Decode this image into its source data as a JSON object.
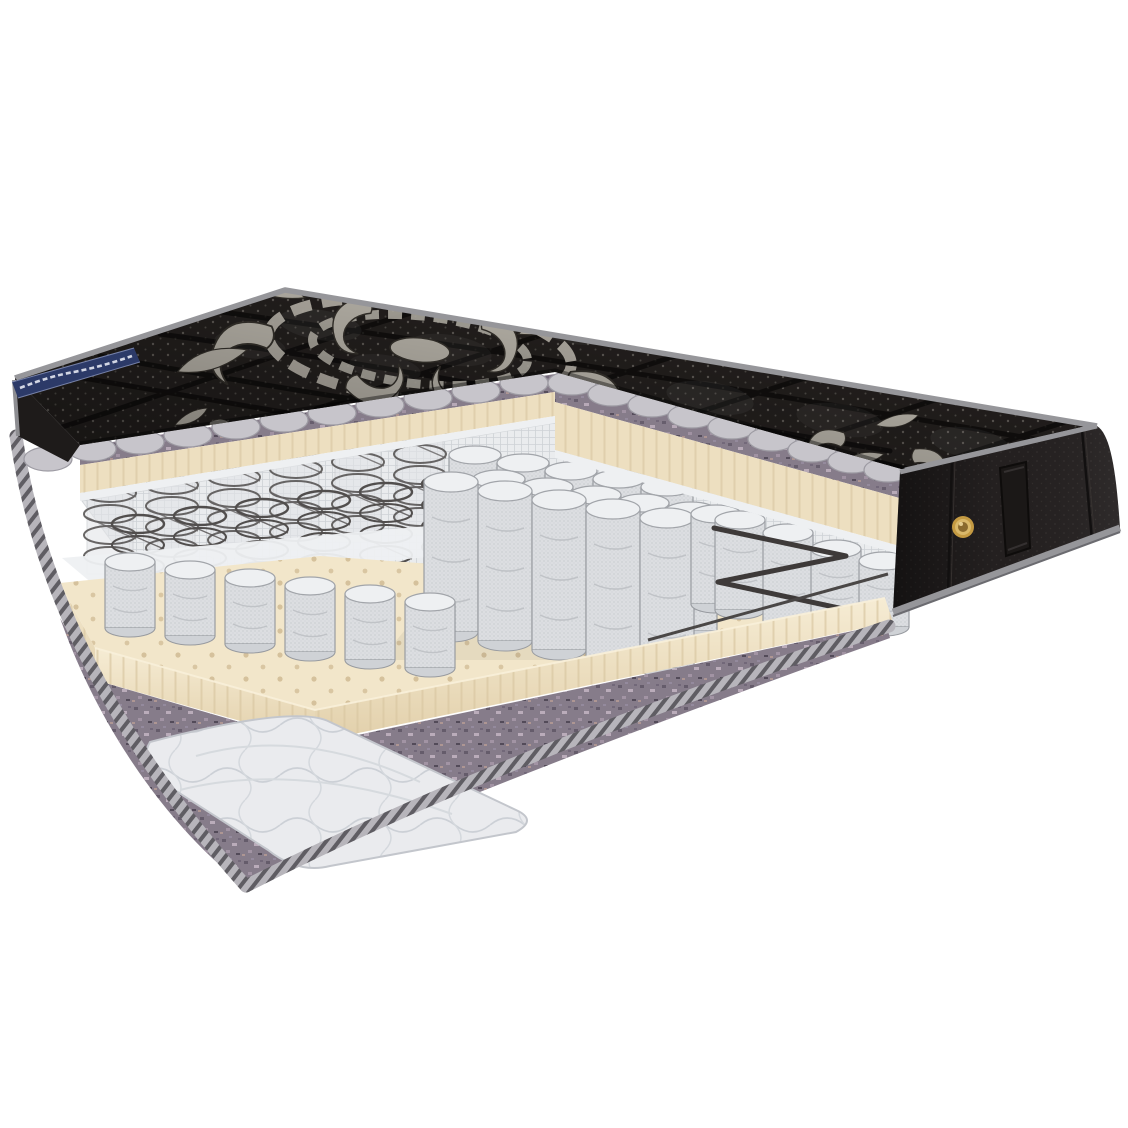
{
  "scene": {
    "description": "Cutaway product render of a mattress on a white background; the front-left quarter is sliced away to reveal internal layers",
    "background": "#ffffff"
  },
  "depicted_parts": [
    "black quilted top cover with silver damask embroidery and pin-dot fabric",
    "gray quilt backing with scalloped cut edge",
    "purple-gray felt pad",
    "perforated cream latex comfort layer",
    "white spring-cover fabric",
    "open steel coil springs",
    "independent pocket springs (raised block)",
    "zigzag border wire",
    "perforated cream latex base layer with stepped cut",
    "felt base pad",
    "white quilted base cover corner",
    "gray striped edge binding",
    "black side panel with vertical handle and brass air vent",
    "navy brand ribbon with illegible white script on the top-left edge"
  ],
  "brand_ribbon": {
    "color": "#2c3a68",
    "script_color": "#e4e8f2"
  },
  "colors": {
    "background": "#ffffff",
    "cover_black": "#262220",
    "cover_shadow": "#131110",
    "piping": "#96969a",
    "piping_dark": "#6b6b70",
    "ribbon_navy": "#2c3a68",
    "side_panel": "#242020",
    "quilt_backing": "#c7c5cb",
    "quilt_backing_edge": "#9d9ba3",
    "felt": "#867c8a",
    "felt_dark": "#665d6b",
    "latex": "#f2e6ca",
    "latex_face": "#eddfc0",
    "latex_rib": "#d9c7a2",
    "latex_hole": "#d2bd97",
    "mesh_white": "#eaecee",
    "pocket_mesh": "#dcdee1",
    "pocket_top": "#eef0f2",
    "pocket_line": "#989ba0",
    "coil_wire": "#514e4d",
    "zigzag_wire": "#3e3a39",
    "bottom_quilt": "#eaebee",
    "binding_base": "#b7b5bb",
    "binding_stripe": "#5f5d63",
    "vent_gold": "#c49a42",
    "vent_gold_dark": "#8a6a2e",
    "handle": "#1b1817",
    "damask_silver": "#c9c4b9",
    "damask_shadow": "#39352f"
  }
}
